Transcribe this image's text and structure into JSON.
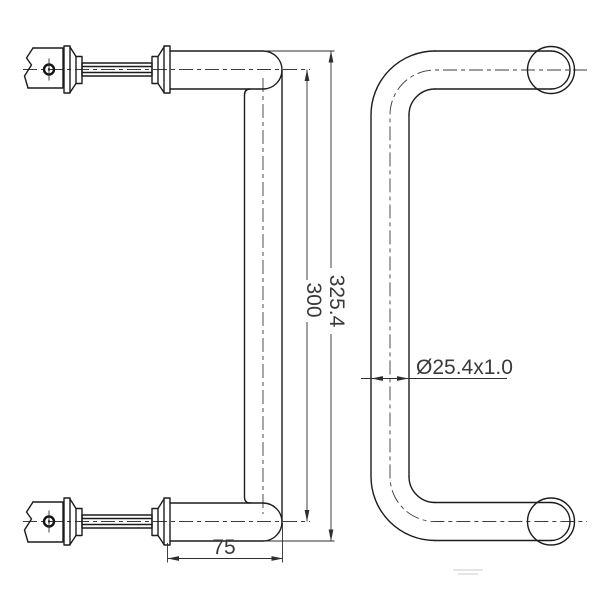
{
  "drawing": {
    "background": "#ffffff",
    "line_color": "#1c1c1c",
    "dimension_text_color": "#3a3a3a",
    "views": {
      "left": "side-view-with-through-bolt-mounting",
      "right": "front-view-of-pull-handle"
    },
    "dimensions": {
      "overall_height": "325.4",
      "hole_centers": "300",
      "projection": "75",
      "tube_spec": "Ø25.4x1.0"
    }
  }
}
